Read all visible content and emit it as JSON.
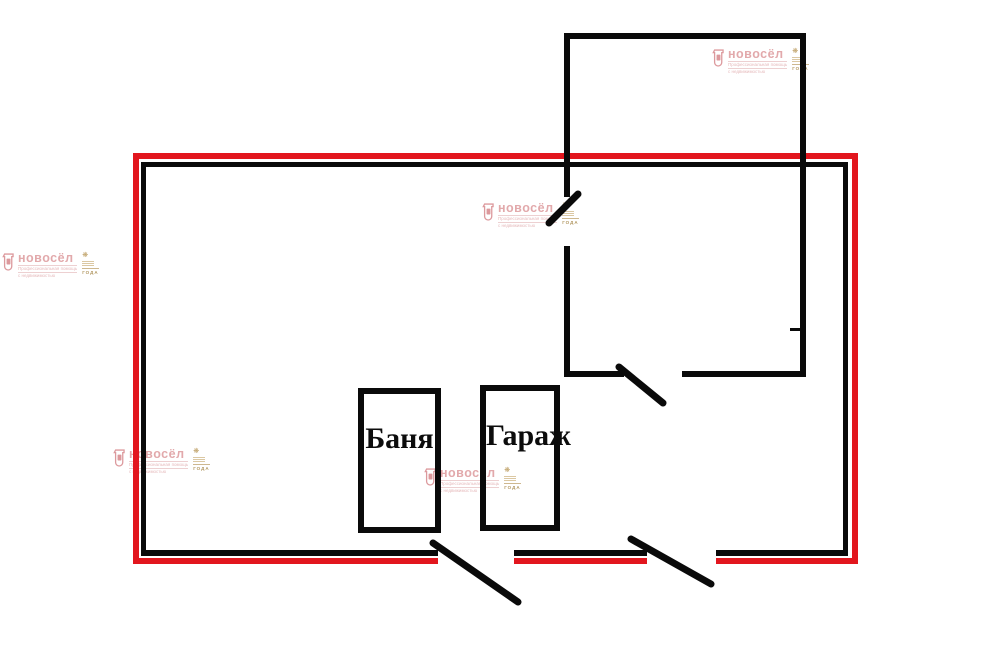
{
  "page": {
    "kind": "floor-plan",
    "background": "#ffffff"
  },
  "colors": {
    "plot_boundary_red": "#e2161e",
    "wall_black": "#0a0a0a",
    "watermark_pink": "#dfa0a3",
    "watermark_gold": "#b5924f"
  },
  "plan": {
    "rooms": [
      {
        "label": "Баня"
      },
      {
        "label": "Гараж"
      }
    ]
  },
  "watermark": {
    "brand": "новосёл",
    "tagline_line1": "Профессиональная помощь",
    "tagline_line2": "с недвижимостью",
    "badge_text": "ГОДА"
  }
}
